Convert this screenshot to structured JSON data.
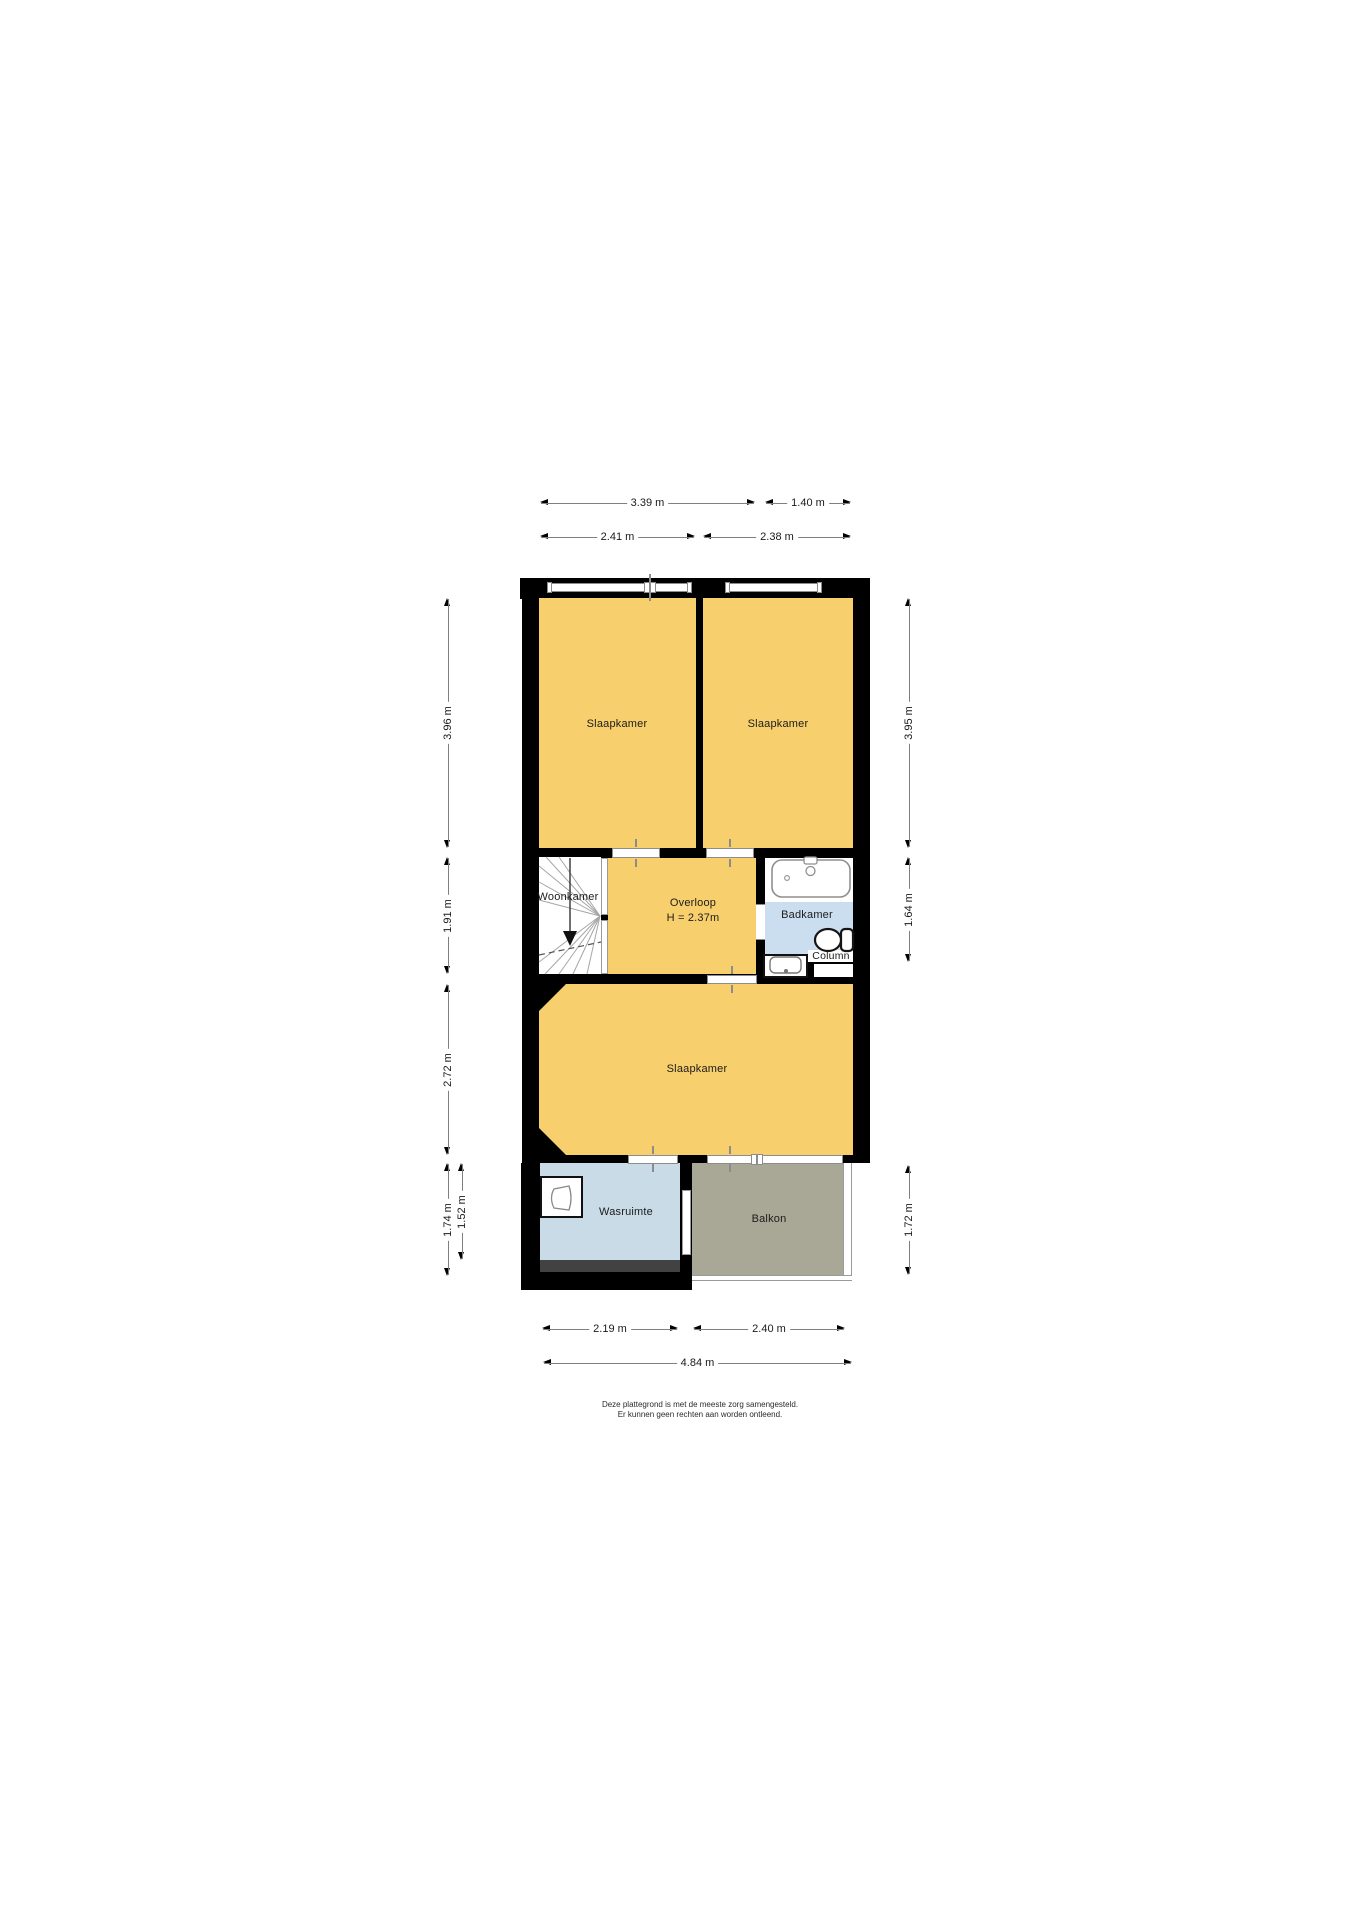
{
  "floorplan": {
    "rooms": {
      "bedroom_top_left": {
        "label": "Slaapkamer"
      },
      "bedroom_top_right": {
        "label": "Slaapkamer"
      },
      "bedroom_bottom": {
        "label": "Slaapkamer"
      },
      "landing": {
        "label": "Overloop",
        "height_note": "H = 2.37m"
      },
      "bathroom": {
        "label": "Badkamer"
      },
      "laundry_room": {
        "label": "Wasruimte"
      },
      "balcony": {
        "label": "Balkon"
      },
      "stairwell": {
        "label": "Woonkamer"
      },
      "column": {
        "label": "Column"
      }
    },
    "dimensions": {
      "top_row_outer": [
        {
          "label": "3.39 m"
        },
        {
          "label": "1.40 m"
        }
      ],
      "top_row_inner": [
        {
          "label": "2.41 m"
        },
        {
          "label": "2.38 m"
        }
      ],
      "left": [
        {
          "label": "3.96 m"
        },
        {
          "label": "1.91 m"
        },
        {
          "label": "2.72 m"
        },
        {
          "label": "1.74 m"
        },
        {
          "label": "1.52 m"
        }
      ],
      "right": [
        {
          "label": "3.95 m"
        },
        {
          "label": "1.64 m"
        },
        {
          "label": "1.72 m"
        }
      ],
      "bottom_row_inner": [
        {
          "label": "2.19 m"
        },
        {
          "label": "2.40 m"
        }
      ],
      "bottom_row_outer": [
        {
          "label": "4.84 m"
        }
      ]
    },
    "disclaimer": {
      "line1": "Deze plattegrond is met de meeste zorg samengesteld.",
      "line2": "Er kunnen geen rechten aan worden ontleend."
    },
    "colors": {
      "room_fill": "#F7CF6C",
      "bathroom_floor": "#CBDEEF",
      "laundry_floor": "#C9DBE7",
      "balcony_floor": "#A9A795",
      "wall": "#000000",
      "mat_strip": "#424242"
    }
  }
}
